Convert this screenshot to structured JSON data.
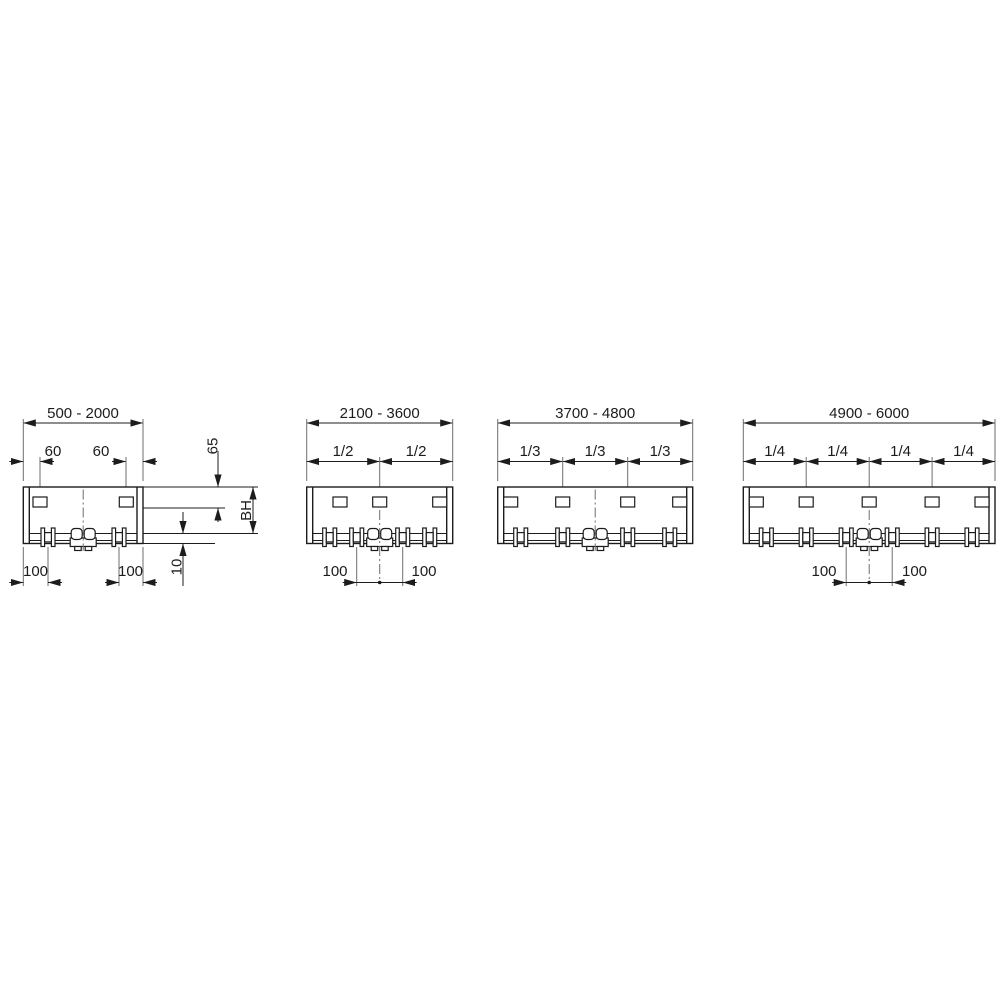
{
  "drawing": {
    "type": "technical-installation-diagram",
    "background": "#ffffff",
    "line_color": "#1c1c1c",
    "centerline_color": "#6e6e6e",
    "panels": [
      {
        "range": "500 - 2000",
        "slot_offset_dims": [
          "60",
          "60"
        ],
        "right_dims": {
          "slot_depth": "65",
          "build_height": "BH",
          "base_thickness": "10"
        },
        "bottom_dims": [
          "100",
          "100"
        ]
      },
      {
        "range": "2100 - 3600",
        "division_dims": [
          "1/2",
          "1/2"
        ],
        "bottom_dims": [
          "100",
          "100"
        ]
      },
      {
        "range": "3700 - 4800",
        "division_dims": [
          "1/3",
          "1/3",
          "1/3"
        ],
        "bottom_dims": []
      },
      {
        "range": "4900 - 6000",
        "division_dims": [
          "1/4",
          "1/4",
          "1/4",
          "1/4"
        ],
        "bottom_dims": [
          "100",
          "100"
        ]
      }
    ]
  }
}
